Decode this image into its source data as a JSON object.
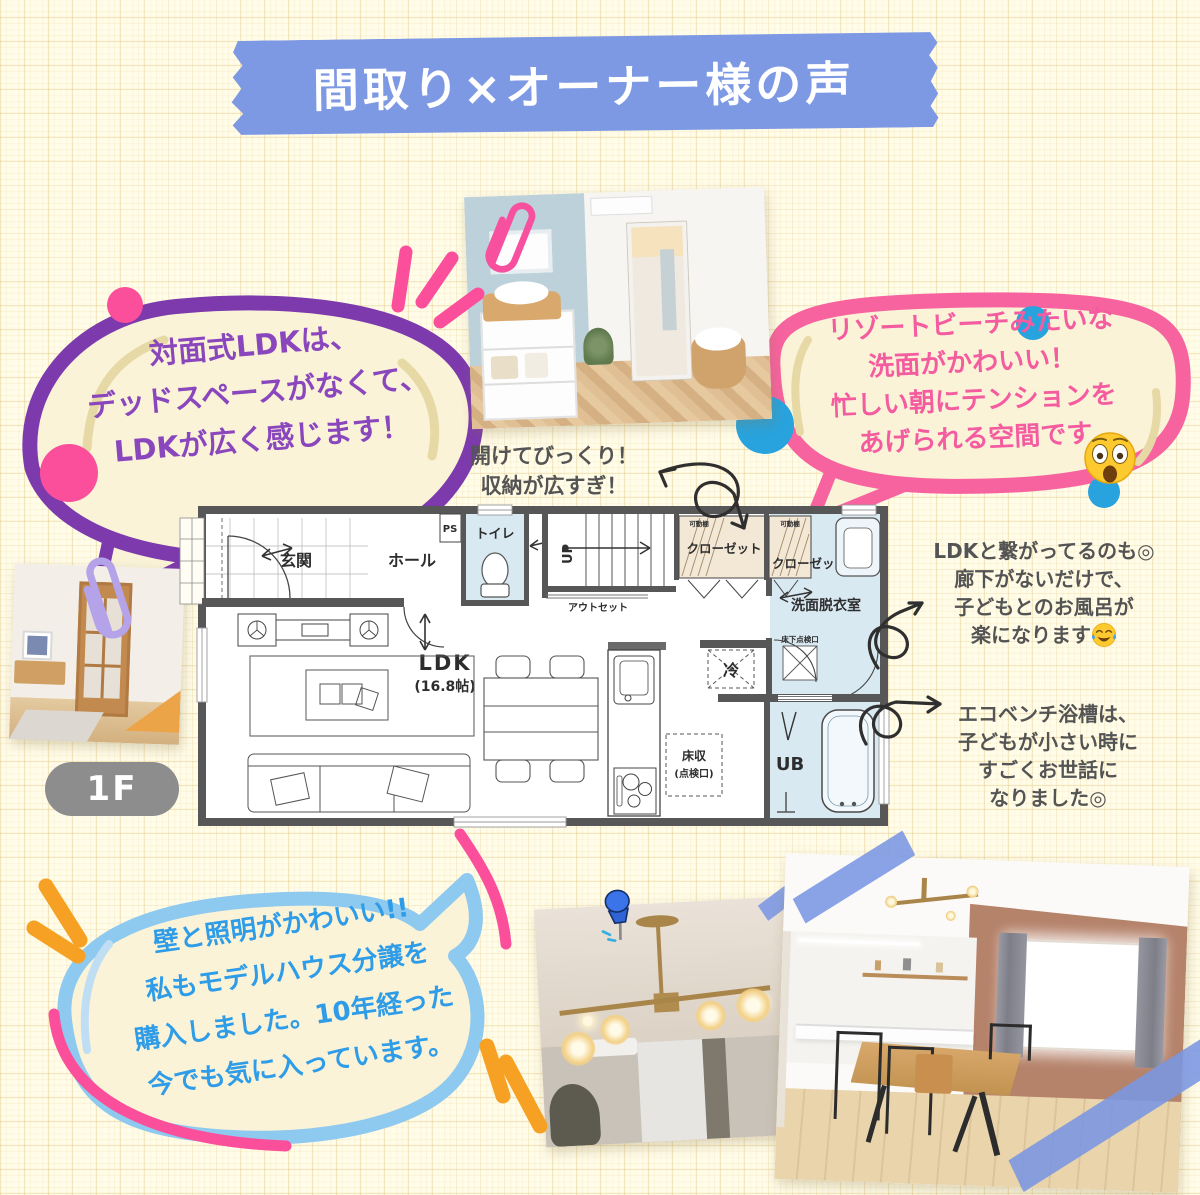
{
  "title_banner": {
    "text": "間取り×オーナー様の声",
    "color": "#7e99e4"
  },
  "floor_badge": {
    "label": "1F"
  },
  "bubbles": {
    "purple": {
      "border_color": "#7c3aad",
      "text_color": "#8a46bd",
      "fill": "#faf3d8",
      "lines": [
        "対面式LDKは、",
        "デッドスペースがなくて、",
        "LDKが広く感じます！"
      ]
    },
    "pink": {
      "border_color": "#f7639f",
      "text_color": "#f45c9f",
      "fill": "#faf3d8",
      "lines": [
        "リゾートビーチみたいな",
        "洗面がかわいい！",
        "忙しい朝にテンションを",
        "あげられる空間です"
      ],
      "emoji": "astonished-face"
    },
    "blue": {
      "border_color": "#8ec9f0",
      "text_color": "#2f9ce8",
      "fill": "#faf3d8",
      "lines": [
        "壁と照明がかわいい!!",
        "私もモデルハウス分譲を",
        "購入しました。10年経った",
        "今でも気に入っています。"
      ]
    }
  },
  "annotations": {
    "storage": {
      "lines": [
        "開けてびっくり！",
        "収納が広すぎ！"
      ]
    },
    "bath_access": {
      "lines": [
        "LDKと繋がってるのも◎",
        "廊下がないだけで、",
        "子どもとのお風呂が",
        "楽になります"
      ],
      "emoji": "joy-face"
    },
    "eco_bench": {
      "lines": [
        "エコベンチ浴槽は、",
        "子どもが小さい時に",
        "すごくお世話に",
        "なりました◎"
      ]
    }
  },
  "floorplan": {
    "labels": {
      "entrance": "玄関",
      "hall": "ホール",
      "ps": "PS",
      "toilet": "トイレ",
      "up": "UP",
      "outset": "アウトセット",
      "closet1": "クローゼット",
      "shelf1": "可動棚",
      "closet2": "クローゼット",
      "shelf2": "可動棚",
      "washroom": "洗面脱衣室",
      "hatch_inspection": "床下点検口",
      "fridge": "冷",
      "bath": "UB",
      "floor_storage_1": "床収",
      "floor_storage_2": "(点検口)",
      "ldk": "LDK",
      "ldk_size": "(16.8帖)"
    },
    "room_fill_blue": "#d9e9f2",
    "closet_fill": "#f3e8d6",
    "wall_color": "#575757"
  },
  "accents": {
    "pink": "#fb4f9b",
    "orange": "#f6a123",
    "arrow_gray": "#2f2f2f",
    "tape_blue": "#7a96e3",
    "clip_purple": "#b5a3ea",
    "clip_pink": "#f6509e",
    "pushpin_blue": "#2f63d6"
  }
}
